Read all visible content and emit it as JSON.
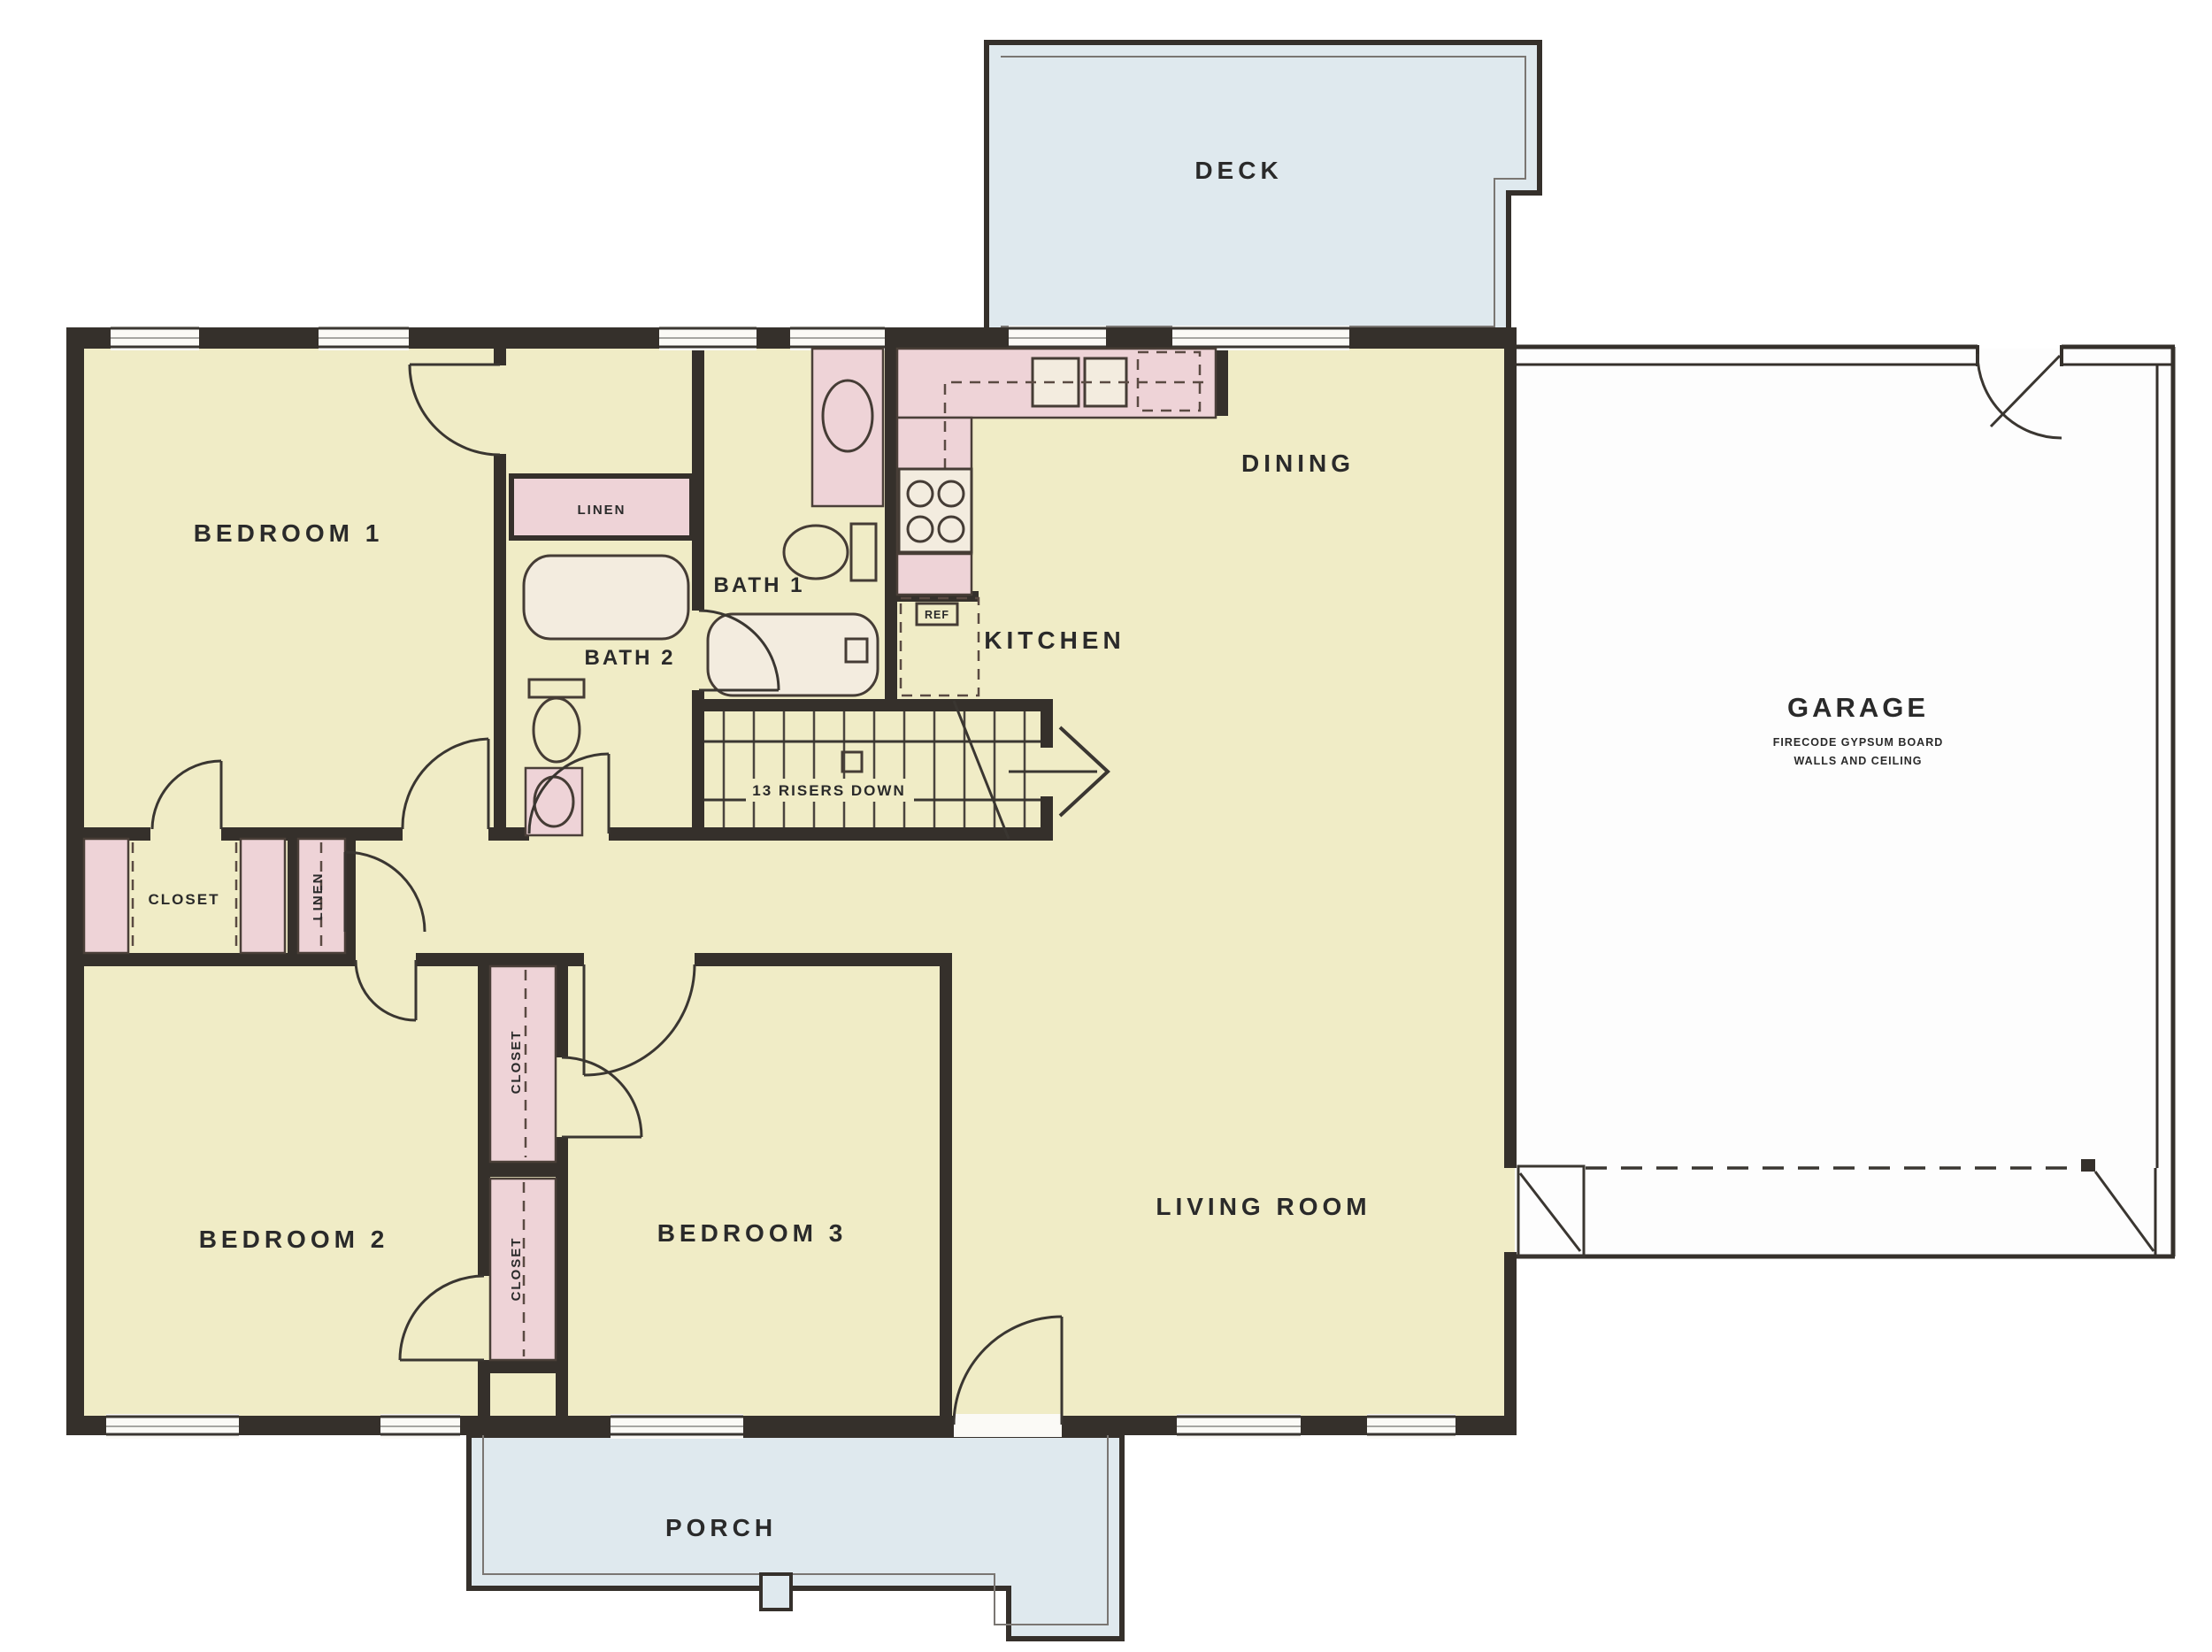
{
  "plan": {
    "rooms": {
      "deck": "DECK",
      "dining": "DINING",
      "kitchen": "KITCHEN",
      "garage": "GARAGE",
      "garage_note_line1": "FIRECODE GYPSUM BOARD",
      "garage_note_line2": "WALLS AND CEILING",
      "bedroom1": "BEDROOM 1",
      "bedroom2": "BEDROOM 2",
      "bedroom3": "BEDROOM 3",
      "living_room": "LIVING ROOM",
      "porch": "PORCH",
      "bath1": "BATH 1",
      "bath2": "BATH 2"
    },
    "closets": {
      "hall_closet": "CLOSET",
      "hall_linen": "LINEN",
      "bath_linen": "LINEN",
      "bedroom2_closet": "CLOSET",
      "bedroom3_closet": "CLOSET"
    },
    "stairs": {
      "note": "13 RISERS DOWN"
    },
    "appliances": {
      "refrigerator": "REF"
    },
    "colors": {
      "wall": "#35302b",
      "floor": "#f0ecc6",
      "cabinet_pink": "#eed3d7",
      "deck_blue": "#dfe9ee",
      "garage_white": "#fdfdfd",
      "text": "#2a2a2a",
      "background": "#ffffff"
    }
  }
}
